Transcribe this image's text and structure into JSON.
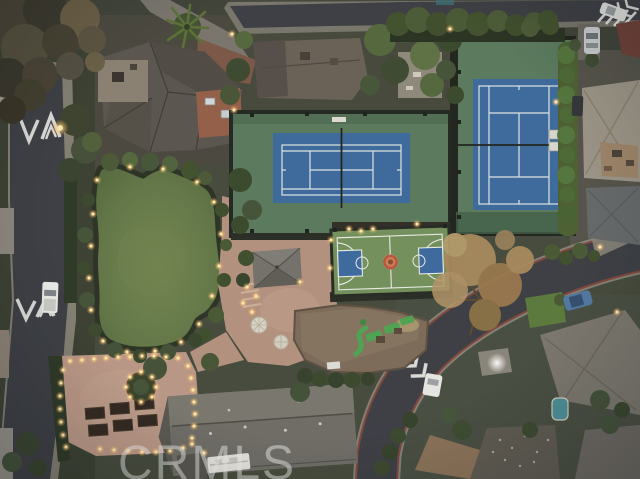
{
  "watermark": {
    "text": "CRMLS"
  },
  "palette": {
    "asphalt": "#3e4045",
    "sidewalk-concrete": "#8f8a7f",
    "curb-red": "#7e3a31",
    "road-marking-white": "#e9e9e5",
    "tennis-court-blue": "#3e6b9c",
    "tennis-surround-green": "#5b7a5e",
    "basketball-court-green": "#74905d",
    "basketball-key-blue": "#3f6a9e",
    "basketball-center-red": "#b5563f",
    "lawn-green": "#66794a",
    "paver-tan": "#b3917f",
    "roof-dark-gray": "#5b5750",
    "roof-light-gray": "#9b9486",
    "tile-red": "#95604a",
    "hedge-green": "#43522f",
    "autumn-tree-gold": "#a8895e",
    "playground-rubber-brown": "#7d6c59",
    "playground-equipment-green": "#4fa352",
    "pool-teal": "#4e8f96",
    "warm-light": "#ffd27f",
    "watermark-gray": "#eaeae8"
  }
}
